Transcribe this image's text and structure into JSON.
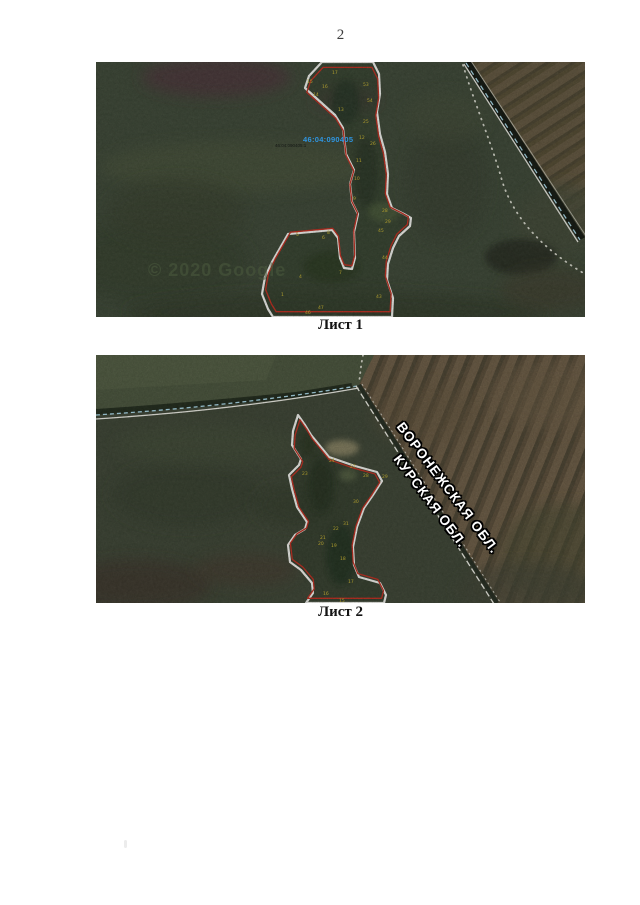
{
  "page": {
    "number": "2"
  },
  "figures": [
    {
      "caption": "Лист 1",
      "map": {
        "quarter_label": "46:04:090405",
        "parcel_label": "46:04:090405:1",
        "watermark": "© 2020 Google",
        "vertices": [
          {
            "n": "17",
            "x": 236,
            "y": 12
          },
          {
            "n": "15",
            "x": 211,
            "y": 21
          },
          {
            "n": "16",
            "x": 226,
            "y": 26
          },
          {
            "n": "14",
            "x": 217,
            "y": 34
          },
          {
            "n": "53",
            "x": 267,
            "y": 24
          },
          {
            "n": "54",
            "x": 271,
            "y": 40
          },
          {
            "n": "13",
            "x": 242,
            "y": 49
          },
          {
            "n": "25",
            "x": 267,
            "y": 61
          },
          {
            "n": "12",
            "x": 263,
            "y": 77
          },
          {
            "n": "26",
            "x": 274,
            "y": 83
          },
          {
            "n": "11",
            "x": 260,
            "y": 100
          },
          {
            "n": "10",
            "x": 258,
            "y": 118
          },
          {
            "n": "9",
            "x": 257,
            "y": 138
          },
          {
            "n": "28",
            "x": 286,
            "y": 150
          },
          {
            "n": "29",
            "x": 289,
            "y": 161
          },
          {
            "n": "45",
            "x": 282,
            "y": 170
          },
          {
            "n": "44",
            "x": 286,
            "y": 197
          },
          {
            "n": "8",
            "x": 231,
            "y": 172
          },
          {
            "n": "6",
            "x": 226,
            "y": 177
          },
          {
            "n": "5",
            "x": 200,
            "y": 174
          },
          {
            "n": "4",
            "x": 203,
            "y": 216
          },
          {
            "n": "7",
            "x": 243,
            "y": 212
          },
          {
            "n": "1",
            "x": 185,
            "y": 234
          },
          {
            "n": "43",
            "x": 280,
            "y": 236
          },
          {
            "n": "46",
            "x": 209,
            "y": 252
          },
          {
            "n": "47",
            "x": 222,
            "y": 247
          }
        ]
      }
    },
    {
      "caption": "Лист 2",
      "map": {
        "region_top": "ВОРОНЕЖСКАЯ ОБЛ.",
        "region_bottom": "КУРСКАЯ ОБЛ.",
        "vertices": [
          {
            "n": "24",
            "x": 233,
            "y": 107
          },
          {
            "n": "27",
            "x": 254,
            "y": 113
          },
          {
            "n": "23",
            "x": 206,
            "y": 120
          },
          {
            "n": "28",
            "x": 267,
            "y": 122
          },
          {
            "n": "29",
            "x": 286,
            "y": 123
          },
          {
            "n": "30",
            "x": 257,
            "y": 148
          },
          {
            "n": "31",
            "x": 247,
            "y": 170
          },
          {
            "n": "22",
            "x": 237,
            "y": 175
          },
          {
            "n": "21",
            "x": 224,
            "y": 184
          },
          {
            "n": "20",
            "x": 222,
            "y": 190
          },
          {
            "n": "19",
            "x": 235,
            "y": 192
          },
          {
            "n": "18",
            "x": 244,
            "y": 205
          },
          {
            "n": "17",
            "x": 252,
            "y": 228
          },
          {
            "n": "16",
            "x": 227,
            "y": 240
          },
          {
            "n": "15",
            "x": 243,
            "y": 247
          }
        ]
      }
    }
  ],
  "colors": {
    "parcel_outline_white": "#f2f2ee",
    "parcel_outline_red": "#c02b1d",
    "vertex_number_yellow": "#c9b42e",
    "quarter_label_blue": "#2f95e0",
    "field_green_dark": "#3a4232",
    "field_brown": "#57492f",
    "boundary_dash_blue": "#a8d8e8"
  }
}
